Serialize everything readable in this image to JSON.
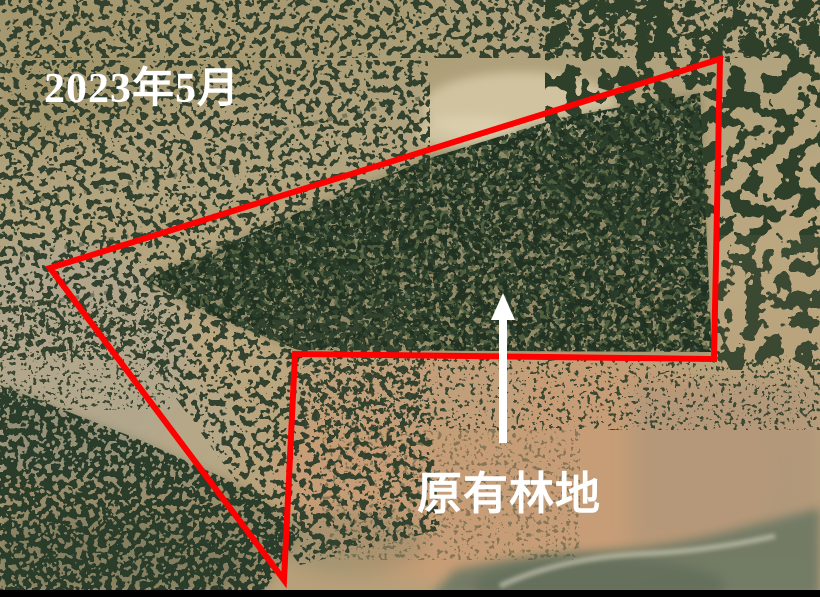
{
  "annotation": {
    "date_label": "2023年5月",
    "area_label": "原有林地",
    "label_color": "#ffffff",
    "outline_color": "#ff0000",
    "outline_width": 6,
    "region_polygon_points": "50,268 720,59 714,359 295,354 284,580",
    "arrow": {
      "tail_x": 503,
      "tail_y": 443,
      "tip_x": 503,
      "tip_y": 293,
      "shaft_width": 8,
      "head_width": 24,
      "head_length": 27,
      "color": "#ffffff"
    }
  }
}
